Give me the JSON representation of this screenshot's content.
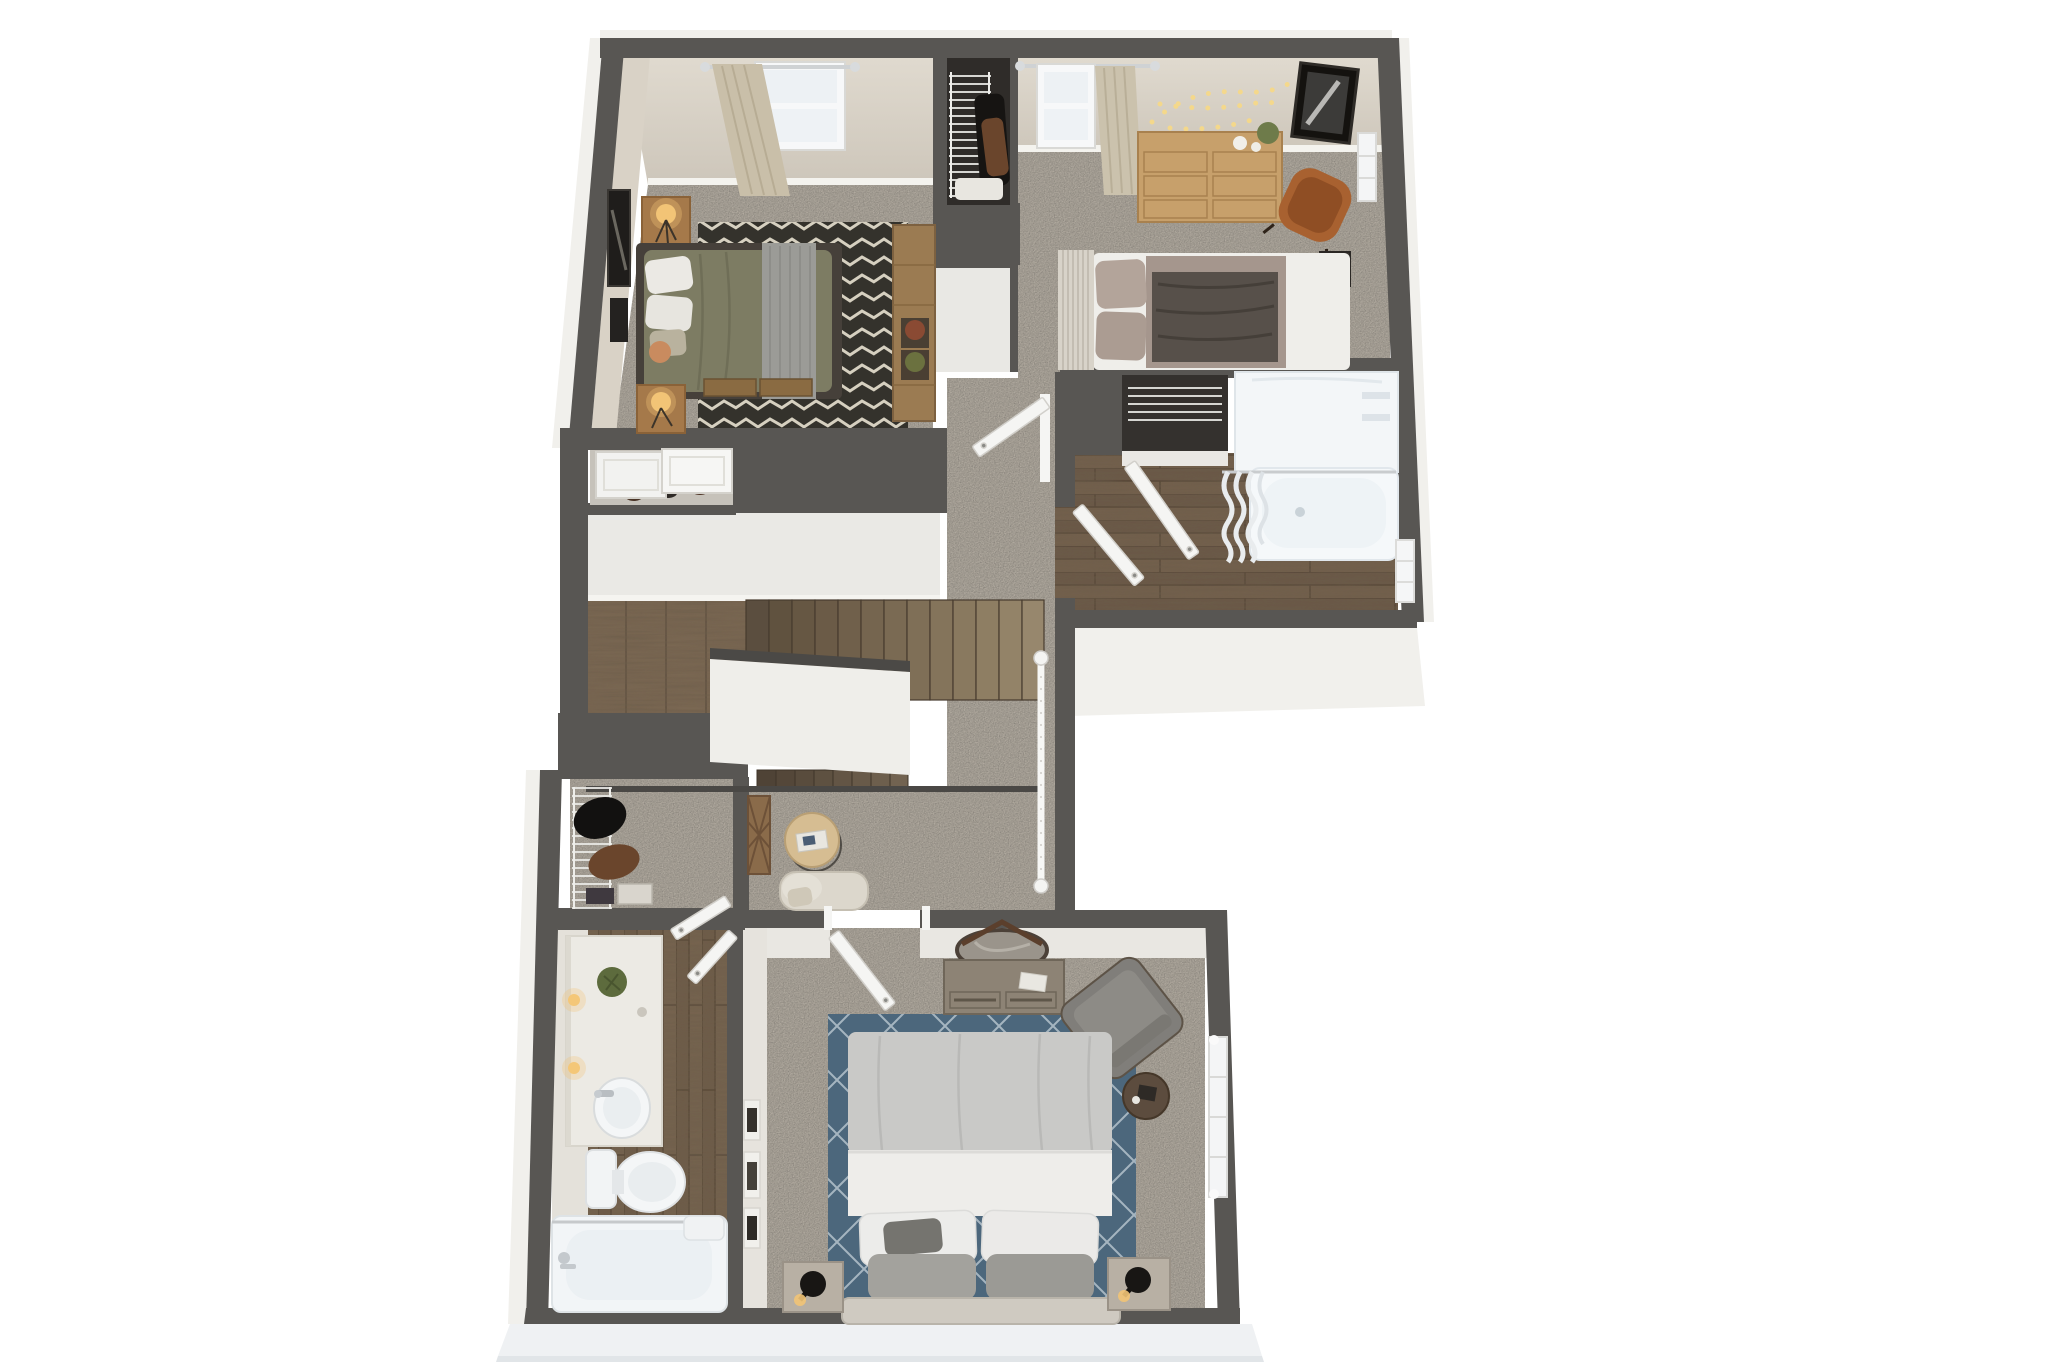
{
  "meta": {
    "kind": "3d-floor-plan-rendering",
    "style": "top-down dollhouse view, two-story apartment upper floor",
    "background": "#ffffff"
  },
  "palette": {
    "wall": "#585653",
    "wall_face_beige": "#d9d2c6",
    "wall_face_white": "#eae9e5",
    "outer_face": "#f1f0ec",
    "slab": "#eff1f3",
    "carpet": "#b5aea3",
    "wood_floor": "#6e5c49",
    "wood_stair": "#7a6852",
    "fixture_white": "#f3f6f8",
    "door_white": "#f5f5f3",
    "rug_chevron_dark": "#34322c",
    "rug_chevron_light": "#d6d0c0",
    "rug_diamond_blue": "#4c677c",
    "bed2_olive": "#7d7c63",
    "bed3_white": "#efeeea",
    "master_duvet": "#c9c9c7",
    "wood_furniture": "#a5794a",
    "dresser_wood": "#c7a06b",
    "chair_cognac": "#a86130",
    "chair_gray": "#807e7a",
    "cream_chair": "#dcd7cc",
    "lamp_glow": "#f2c476"
  },
  "rooms": [
    {
      "id": "bedroom-2",
      "label": "bedroom upper-left",
      "items": [
        "olive-bed",
        "two-nightstands",
        "table-lamps",
        "chevron-rug",
        "console-table-with-plants",
        "wall-art",
        "window-with-curtain"
      ]
    },
    {
      "id": "closet-bedroom-3",
      "label": "reach-in closet",
      "items": [
        "wire-shelf",
        "hanging-clothes",
        "folded-linens"
      ]
    },
    {
      "id": "bedroom-3",
      "label": "bedroom upper-right",
      "items": [
        "white-gray-bed",
        "slat-headboard",
        "six-drawer-dresser",
        "cognac-accent-chair",
        "string-lights",
        "framed-art",
        "cube-side-table",
        "two-windows",
        "curtain"
      ]
    },
    {
      "id": "bathroom-upper",
      "label": "full bathroom",
      "items": [
        "tub-shower",
        "shower-curtain",
        "wire-shelf-nook",
        "two-doors",
        "window"
      ]
    },
    {
      "id": "linen-closet",
      "label": "linen closet",
      "items": [
        "sliding-doors",
        "shoes"
      ]
    },
    {
      "id": "stairwell",
      "label": "staircase",
      "items": [
        "upper-flight",
        "half-wall",
        "lower-flight",
        "white-railing"
      ]
    },
    {
      "id": "hallway-landing",
      "label": "hallway and landing",
      "items": [
        "round-side-table",
        "magazine",
        "cream-armchair",
        "decor-ladder-art"
      ]
    },
    {
      "id": "walk-in-closet",
      "label": "walk-in closet",
      "items": [
        "wire-shelf",
        "hanging-clothes",
        "storage-boxes",
        "door"
      ]
    },
    {
      "id": "bathroom-master",
      "label": "hall bathroom",
      "items": [
        "vanity-with-sink",
        "plant",
        "sconce-lights",
        "toilet",
        "bathtub",
        "door"
      ]
    },
    {
      "id": "master-bedroom",
      "label": "master bedroom",
      "items": [
        "bed-with-gray-duvet",
        "pillows",
        "upholstered-headboard",
        "blue-diamond-rug",
        "dresser-with-round-mirror",
        "gray-accent-chair",
        "round-side-table",
        "two-nightstands",
        "black-lamps",
        "leaning-frames",
        "window",
        "door"
      ]
    }
  ]
}
